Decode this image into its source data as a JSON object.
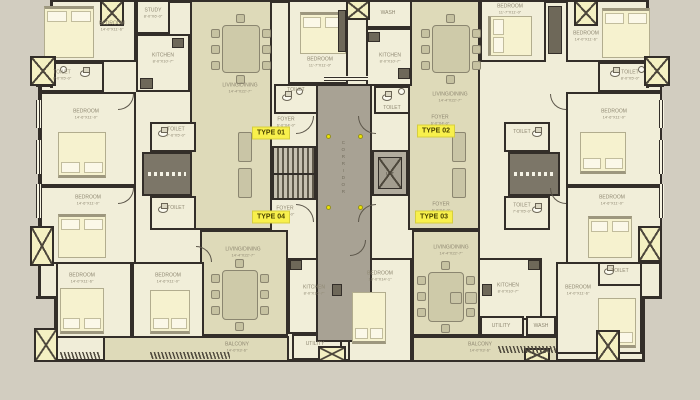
{
  "type_labels": {
    "t1": "TYPE 01",
    "t2": "TYPE 02",
    "t3": "TYPE 03",
    "t4": "TYPE 04"
  },
  "core": {
    "corridor": "CORRIDOR",
    "lift": "LIFT"
  },
  "room_names": {
    "bedroom": "BEDROOM",
    "toilet": "TOILET",
    "kitchen": "KITCHEN",
    "living": "LIVING/DINING",
    "balcony": "BALCONY",
    "utility": "UTILITY",
    "foyer": "FOYER",
    "wash": "WASH",
    "study": "STUDY"
  },
  "dims": {
    "bed_a": "14'-0\"X11'-6\"",
    "bed_b": "14'-6\"X11'-0\"",
    "bed_c": "11'-7\"X11'-0\"",
    "bed_d": "10'-0\"X14'-1\"",
    "toilet_a": "8'-0\"X5'-0\"",
    "toilet_b": "7'-6\"X5'-0\"",
    "kitchen": "8'-0\"X10'-7\"",
    "living": "14'-4\"X22'-7\"",
    "balcony": "14'-0\"X3'-6\"",
    "foyer": "6'-0\"X4'-0\"",
    "study": "8'-0\"X6'-0\""
  },
  "colors": {
    "background": "#d2cdc0",
    "wall": "#332e29",
    "room_light": "#f1eed9",
    "room_olive": "#dedab9",
    "corridor_gray": "#a8a294",
    "highlight_yellow": "#f8f04c",
    "bed_fill": "#f6f2cf",
    "shaft_fill": "#f4f0c2",
    "dot_yellow": "#eee600"
  }
}
